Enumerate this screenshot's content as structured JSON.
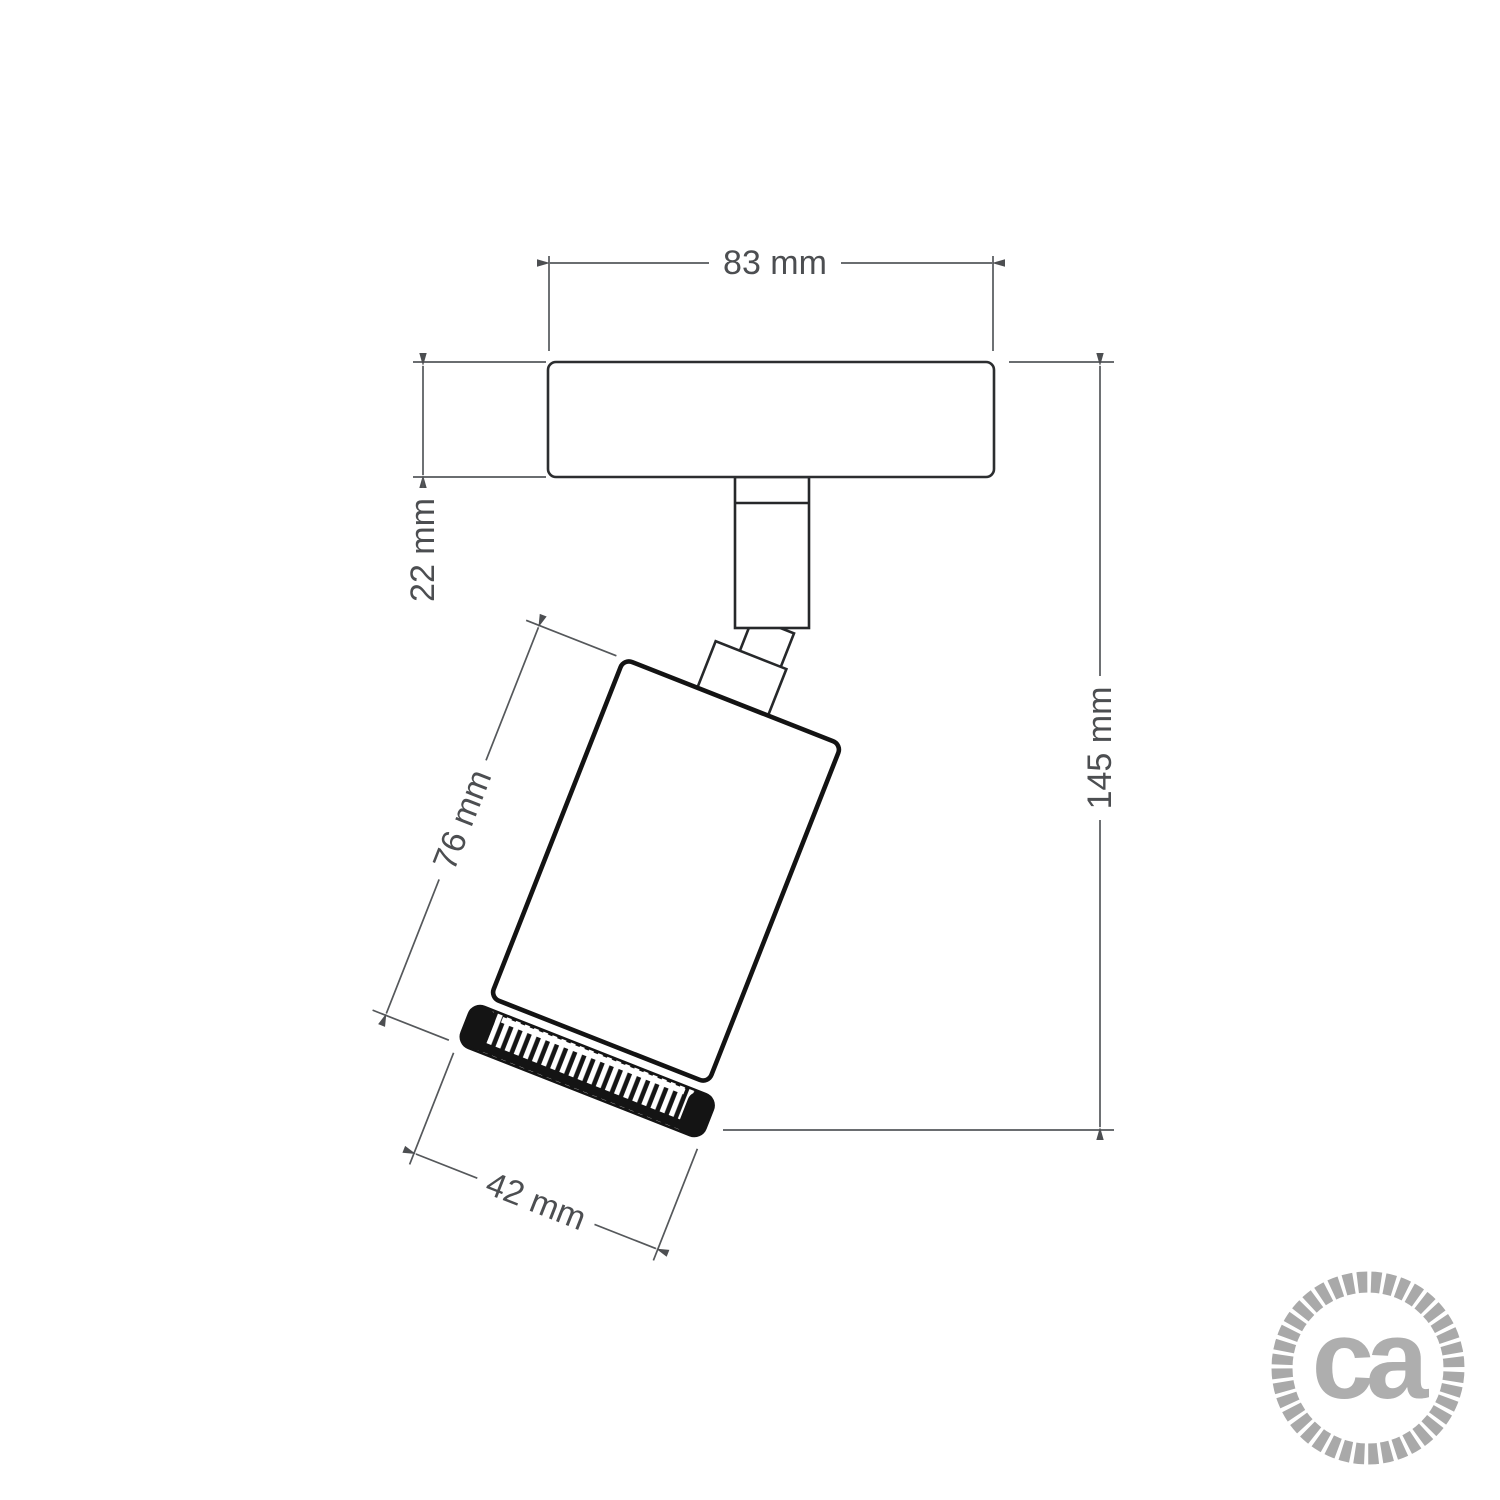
{
  "drawing": {
    "dimensions": {
      "plate_width": "83 mm",
      "plate_thickness": "22 mm",
      "spot_body_length": "76 mm",
      "spot_body_diameter": "42 mm",
      "overall_height": "145 mm"
    },
    "logo": {
      "text": "ca"
    },
    "colors": {
      "dimension": "#4c4e51",
      "outline": "#1a1a1a",
      "logo": "#aeaeae",
      "rope": "#a9a9a9",
      "background": "#ffffff"
    }
  }
}
